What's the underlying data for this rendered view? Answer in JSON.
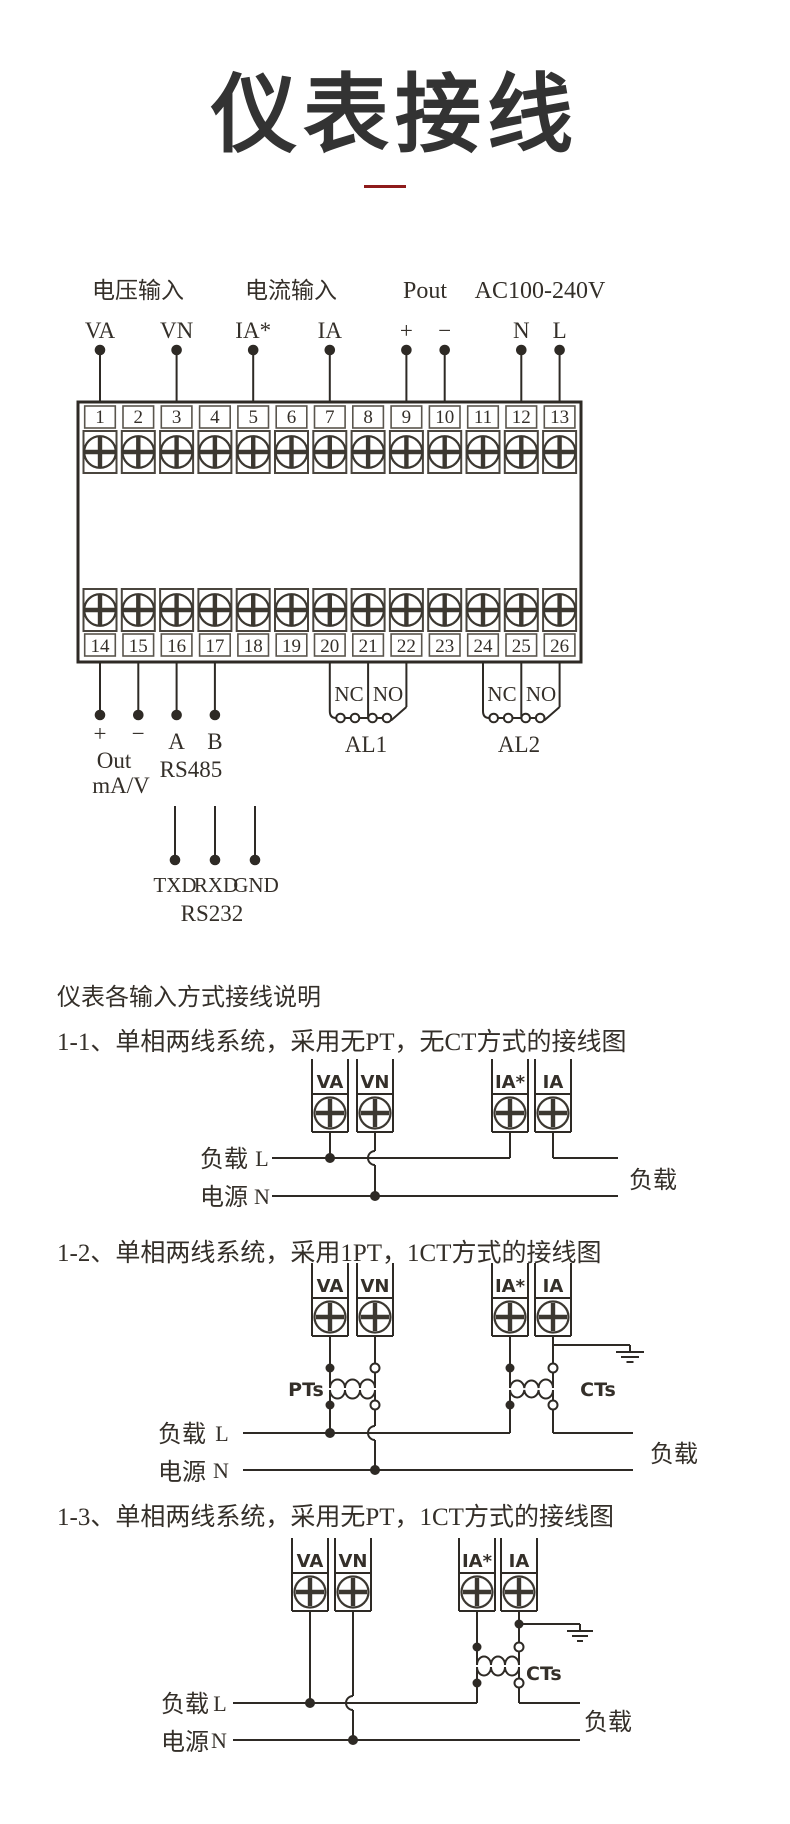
{
  "title": "仪表接线",
  "accent_color": "#8e1b1b",
  "main": {
    "groups": {
      "voltage": "电压输入",
      "current": "电流输入",
      "pout": "Pout",
      "ac": "AC100-240V"
    },
    "pins_top": [
      "VA",
      "VN",
      "IA*",
      "IA",
      "+",
      "−",
      "N",
      "L"
    ],
    "terminals_top": [
      "1",
      "2",
      "3",
      "4",
      "5",
      "6",
      "7",
      "8",
      "9",
      "10",
      "11",
      "12",
      "13"
    ],
    "terminals_bottom": [
      "14",
      "15",
      "16",
      "17",
      "18",
      "19",
      "20",
      "21",
      "22",
      "23",
      "24",
      "25",
      "26"
    ],
    "pins_bottom": [
      "+",
      "−",
      "A",
      "B"
    ],
    "out1": "Out",
    "out2": "mA/V",
    "rs485": "RS485",
    "rs232_pins": [
      "TXD",
      "RXD",
      "GND"
    ],
    "rs232": "RS232",
    "al1": {
      "nc": "NC",
      "no": "NO",
      "name": "AL1"
    },
    "al2": {
      "nc": "NC",
      "no": "NO",
      "name": "AL2"
    }
  },
  "intro": "仪表各输入方式接线说明",
  "d1": {
    "heading": "1-1、单相两线系统，采用无PT，无CT方式的接线图",
    "t": [
      "VA",
      "VN",
      "IA*",
      "IA"
    ],
    "load": "负载",
    "source": "电源",
    "l": "L",
    "n": "N",
    "load_right": "负载"
  },
  "d2": {
    "heading": "1-2、单相两线系统，采用1PT，1CT方式的接线图",
    "t": [
      "VA",
      "VN",
      "IA*",
      "IA"
    ],
    "pt": "PTs",
    "ct": "CTs",
    "load": "负载",
    "source": "电源",
    "l": "L",
    "n": "N",
    "load_right": "负载"
  },
  "d3": {
    "heading": "1-3、单相两线系统，采用无PT，1CT方式的接线图",
    "t": [
      "VA",
      "VN",
      "IA*",
      "IA"
    ],
    "ct": "CTs",
    "load": "负载",
    "source": "电源",
    "l": "L",
    "n": "N",
    "load_right": "负载"
  }
}
